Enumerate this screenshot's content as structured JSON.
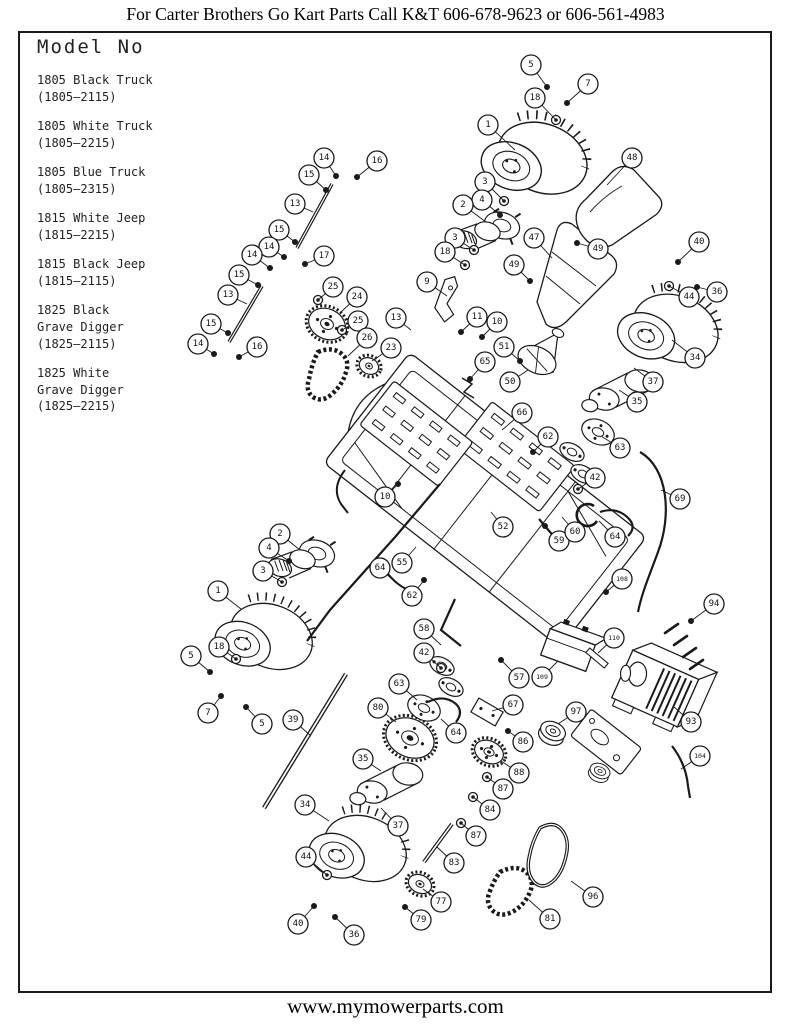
{
  "header": {
    "text": "For Carter Brothers Go Kart Parts Call K&T 606-678-9623 or 606-561-4983"
  },
  "footer": {
    "text": "www.mymowerparts.com"
  },
  "model_box": {
    "title": "Model No",
    "models": [
      {
        "name": "1805 Black Truck",
        "code": "(1805–2115)"
      },
      {
        "name": "1805 White Truck",
        "code": "(1805–2215)"
      },
      {
        "name": "1805 Blue Truck",
        "code": "(1805–2315)"
      },
      {
        "name": "1815 White Jeep",
        "code": "(1815–2215)"
      },
      {
        "name": "1815 Black Jeep",
        "code": "(1815–2115)"
      },
      {
        "name": "1825 Black\nGrave Digger",
        "code": "(1825–2115)"
      },
      {
        "name": "1825 White\nGrave Digger",
        "code": "(1825–2215)"
      }
    ]
  },
  "diagram": {
    "description": "Exploded parts diagram of Carter Brothers go kart",
    "callouts": [
      {
        "n": "5",
        "x": 531,
        "y": 65,
        "tx": 547,
        "ty": 87
      },
      {
        "n": "7",
        "x": 588,
        "y": 84,
        "tx": 567,
        "ty": 103
      },
      {
        "n": "18",
        "x": 535,
        "y": 98,
        "tx": 556,
        "ty": 120
      },
      {
        "n": "1",
        "x": 488,
        "y": 125,
        "tx": 515,
        "ty": 150
      },
      {
        "n": "48",
        "x": 632,
        "y": 158,
        "tx": 607,
        "ty": 185
      },
      {
        "n": "3",
        "x": 485,
        "y": 182,
        "tx": 504,
        "ty": 201
      },
      {
        "n": "4",
        "x": 482,
        "y": 200,
        "tx": 500,
        "ty": 215
      },
      {
        "n": "2",
        "x": 463,
        "y": 205,
        "tx": 486,
        "ty": 222
      },
      {
        "n": "3",
        "x": 455,
        "y": 238,
        "tx": 474,
        "ty": 250
      },
      {
        "n": "18",
        "x": 445,
        "y": 252,
        "tx": 465,
        "ty": 265
      },
      {
        "n": "9",
        "x": 427,
        "y": 282,
        "tx": 447,
        "ty": 296
      },
      {
        "n": "47",
        "x": 534,
        "y": 238,
        "tx": 552,
        "ty": 258
      },
      {
        "n": "49",
        "x": 598,
        "y": 249,
        "tx": 577,
        "ty": 243
      },
      {
        "n": "49",
        "x": 514,
        "y": 265,
        "tx": 530,
        "ty": 281
      },
      {
        "n": "40",
        "x": 699,
        "y": 242,
        "tx": 678,
        "ty": 262
      },
      {
        "n": "44",
        "x": 689,
        "y": 297,
        "tx": 669,
        "ty": 286
      },
      {
        "n": "36",
        "x": 717,
        "y": 292,
        "tx": 697,
        "ty": 287
      },
      {
        "n": "14",
        "x": 324,
        "y": 158,
        "tx": 336,
        "ty": 176
      },
      {
        "n": "15",
        "x": 309,
        "y": 175,
        "tx": 326,
        "ty": 190
      },
      {
        "n": "16",
        "x": 377,
        "y": 161,
        "tx": 357,
        "ty": 177
      },
      {
        "n": "13",
        "x": 295,
        "y": 204,
        "tx": 313,
        "ty": 212
      },
      {
        "n": "15",
        "x": 279,
        "y": 230,
        "tx": 295,
        "ty": 242
      },
      {
        "n": "14",
        "x": 269,
        "y": 247,
        "tx": 284,
        "ty": 257
      },
      {
        "n": "14",
        "x": 252,
        "y": 255,
        "tx": 270,
        "ty": 268
      },
      {
        "n": "15",
        "x": 239,
        "y": 275,
        "tx": 258,
        "ty": 285
      },
      {
        "n": "17",
        "x": 324,
        "y": 256,
        "tx": 305,
        "ty": 264
      },
      {
        "n": "13",
        "x": 228,
        "y": 295,
        "tx": 247,
        "ty": 304
      },
      {
        "n": "15",
        "x": 211,
        "y": 324,
        "tx": 228,
        "ty": 333
      },
      {
        "n": "14",
        "x": 198,
        "y": 344,
        "tx": 214,
        "ty": 354
      },
      {
        "n": "16",
        "x": 257,
        "y": 347,
        "tx": 239,
        "ty": 357
      },
      {
        "n": "25",
        "x": 333,
        "y": 287,
        "tx": 318,
        "ty": 300
      },
      {
        "n": "24",
        "x": 357,
        "y": 297,
        "tx": 341,
        "ty": 312
      },
      {
        "n": "25",
        "x": 358,
        "y": 321,
        "tx": 342,
        "ty": 330
      },
      {
        "n": "26",
        "x": 367,
        "y": 338,
        "tx": 348,
        "ty": 356
      },
      {
        "n": "23",
        "x": 391,
        "y": 348,
        "tx": 372,
        "ty": 361
      },
      {
        "n": "13",
        "x": 396,
        "y": 318,
        "tx": 411,
        "ty": 330
      },
      {
        "n": "11",
        "x": 477,
        "y": 317,
        "tx": 461,
        "ty": 332
      },
      {
        "n": "10",
        "x": 497,
        "y": 322,
        "tx": 482,
        "ty": 337
      },
      {
        "n": "51",
        "x": 504,
        "y": 347,
        "tx": 520,
        "ty": 361
      },
      {
        "n": "65",
        "x": 485,
        "y": 362,
        "tx": 470,
        "ty": 379
      },
      {
        "n": "50",
        "x": 510,
        "y": 382,
        "tx": 528,
        "ty": 370
      },
      {
        "n": "66",
        "x": 522,
        "y": 413,
        "tx": 502,
        "ty": 430
      },
      {
        "n": "62",
        "x": 548,
        "y": 437,
        "tx": 533,
        "ty": 452
      },
      {
        "n": "42",
        "x": 595,
        "y": 478,
        "tx": 578,
        "ty": 489
      },
      {
        "n": "63",
        "x": 620,
        "y": 448,
        "tx": 601,
        "ty": 436
      },
      {
        "n": "10",
        "x": 385,
        "y": 497,
        "tx": 398,
        "ty": 484
      },
      {
        "n": "59",
        "x": 559,
        "y": 541,
        "tx": 545,
        "ty": 526
      },
      {
        "n": "60",
        "x": 575,
        "y": 532,
        "tx": 562,
        "ty": 517
      },
      {
        "n": "64",
        "x": 615,
        "y": 537,
        "tx": 599,
        "ty": 521
      },
      {
        "n": "55",
        "x": 402,
        "y": 563,
        "tx": 416,
        "ty": 547
      },
      {
        "n": "62",
        "x": 412,
        "y": 596,
        "tx": 424,
        "ty": 580
      },
      {
        "n": "52",
        "x": 503,
        "y": 527,
        "tx": 491,
        "ty": 512
      },
      {
        "n": "69",
        "x": 680,
        "y": 499,
        "tx": 661,
        "ty": 490
      },
      {
        "n": "108",
        "x": 622,
        "y": 579,
        "tx": 606,
        "ty": 592
      },
      {
        "n": "94",
        "x": 714,
        "y": 604,
        "tx": 691,
        "ty": 621
      },
      {
        "n": "109",
        "x": 542,
        "y": 677,
        "tx": 558,
        "ty": 661
      },
      {
        "n": "110",
        "x": 614,
        "y": 638,
        "tx": 598,
        "ty": 653
      },
      {
        "n": "57",
        "x": 519,
        "y": 678,
        "tx": 501,
        "ty": 660
      },
      {
        "n": "34",
        "x": 695,
        "y": 358,
        "tx": 672,
        "ty": 340
      },
      {
        "n": "37",
        "x": 653,
        "y": 382,
        "tx": 634,
        "ty": 368
      },
      {
        "n": "35",
        "x": 637,
        "y": 402,
        "tx": 619,
        "ty": 390
      },
      {
        "n": "93",
        "x": 691,
        "y": 722,
        "tx": 673,
        "ty": 706
      },
      {
        "n": "104",
        "x": 700,
        "y": 756,
        "tx": 681,
        "ty": 769
      },
      {
        "n": "97",
        "x": 576,
        "y": 712,
        "tx": 558,
        "ty": 724
      },
      {
        "n": "58",
        "x": 424,
        "y": 629,
        "tx": 441,
        "ty": 645
      },
      {
        "n": "42",
        "x": 424,
        "y": 653,
        "tx": 441,
        "ty": 668
      },
      {
        "n": "63",
        "x": 399,
        "y": 684,
        "tx": 417,
        "ty": 700
      },
      {
        "n": "80",
        "x": 378,
        "y": 708,
        "tx": 396,
        "ty": 722
      },
      {
        "n": "35",
        "x": 363,
        "y": 759,
        "tx": 381,
        "ty": 771
      },
      {
        "n": "37",
        "x": 398,
        "y": 826,
        "tx": 381,
        "ty": 808
      },
      {
        "n": "64",
        "x": 456,
        "y": 733,
        "tx": 441,
        "ty": 719
      },
      {
        "n": "67",
        "x": 513,
        "y": 705,
        "tx": 492,
        "ty": 711
      },
      {
        "n": "86",
        "x": 523,
        "y": 742,
        "tx": 508,
        "ty": 731
      },
      {
        "n": "88",
        "x": 519,
        "y": 773,
        "tx": 501,
        "ty": 761
      },
      {
        "n": "87",
        "x": 503,
        "y": 789,
        "tx": 487,
        "ty": 777
      },
      {
        "n": "84",
        "x": 490,
        "y": 810,
        "tx": 473,
        "ty": 797
      },
      {
        "n": "87",
        "x": 476,
        "y": 836,
        "tx": 461,
        "ty": 823
      },
      {
        "n": "83",
        "x": 454,
        "y": 863,
        "tx": 437,
        "ty": 847
      },
      {
        "n": "77",
        "x": 441,
        "y": 902,
        "tx": 423,
        "ty": 889
      },
      {
        "n": "79",
        "x": 421,
        "y": 920,
        "tx": 405,
        "ty": 907
      },
      {
        "n": "81",
        "x": 550,
        "y": 919,
        "tx": 529,
        "ty": 900
      },
      {
        "n": "96",
        "x": 593,
        "y": 897,
        "tx": 571,
        "ty": 881
      },
      {
        "n": "34",
        "x": 305,
        "y": 805,
        "tx": 329,
        "ty": 821
      },
      {
        "n": "44",
        "x": 306,
        "y": 857,
        "tx": 327,
        "ty": 875
      },
      {
        "n": "40",
        "x": 298,
        "y": 924,
        "tx": 314,
        "ty": 906
      },
      {
        "n": "36",
        "x": 354,
        "y": 935,
        "tx": 335,
        "ty": 917
      },
      {
        "n": "2",
        "x": 280,
        "y": 534,
        "tx": 300,
        "ty": 550
      },
      {
        "n": "4",
        "x": 269,
        "y": 548,
        "tx": 289,
        "ty": 561
      },
      {
        "n": "3",
        "x": 263,
        "y": 571,
        "tx": 282,
        "ty": 582
      },
      {
        "n": "1",
        "x": 218,
        "y": 591,
        "tx": 241,
        "ty": 609
      },
      {
        "n": "18",
        "x": 219,
        "y": 647,
        "tx": 236,
        "ty": 659
      },
      {
        "n": "5",
        "x": 191,
        "y": 656,
        "tx": 210,
        "ty": 672
      },
      {
        "n": "7",
        "x": 208,
        "y": 713,
        "tx": 221,
        "ty": 696
      },
      {
        "n": "5",
        "x": 262,
        "y": 724,
        "tx": 246,
        "ty": 707
      },
      {
        "n": "39",
        "x": 293,
        "y": 720,
        "tx": 311,
        "ty": 736
      },
      {
        "n": "64",
        "x": 380,
        "y": 568,
        "tx": 396,
        "ty": 583
      }
    ]
  }
}
